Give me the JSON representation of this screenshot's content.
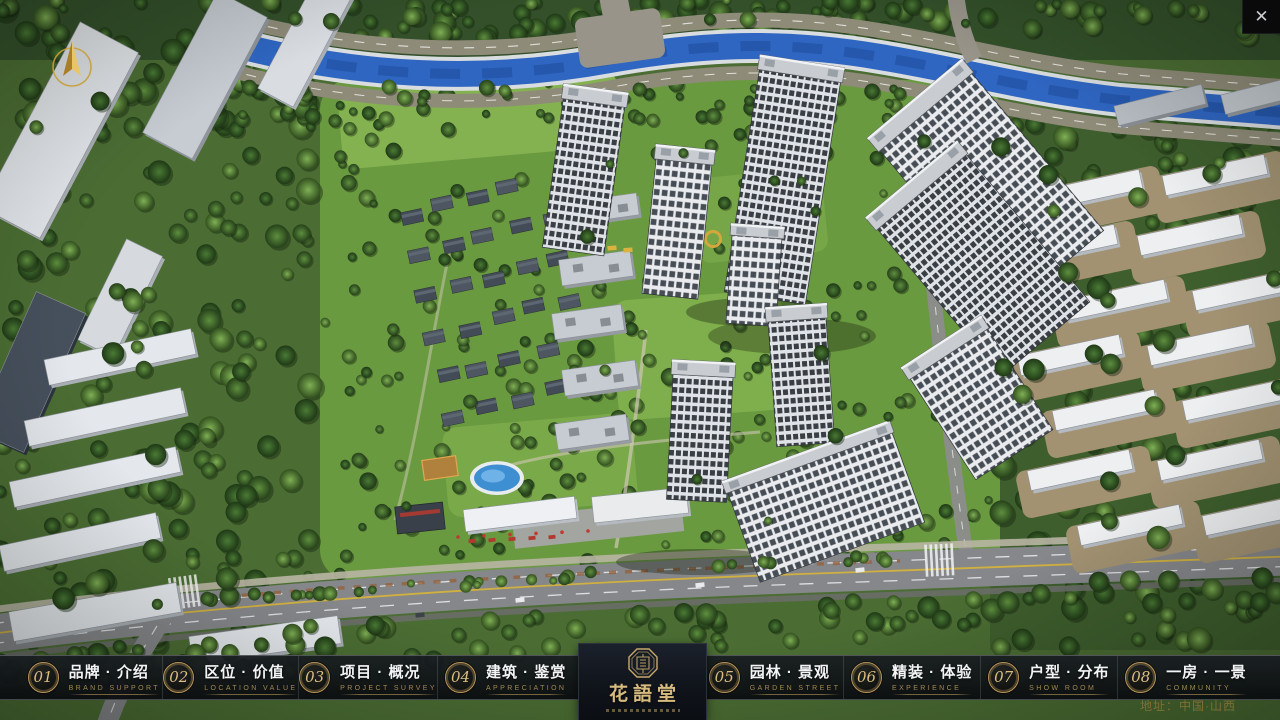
{
  "window": {
    "close_glyph": "✕"
  },
  "logo": {
    "title_cn": "花語堂"
  },
  "footer": {
    "address": "地址：中国·山西"
  },
  "nav": {
    "items": [
      {
        "num": "01",
        "label_cn": "品牌 · 介绍",
        "label_en": "BRAND SUPPORT"
      },
      {
        "num": "02",
        "label_cn": "区位 · 价值",
        "label_en": "LOCATION VALUE"
      },
      {
        "num": "03",
        "label_cn": "项目 · 概况",
        "label_en": "PROJECT SURVEY"
      },
      {
        "num": "04",
        "label_cn": "建筑 · 鉴赏",
        "label_en": "APPRECIATION"
      },
      {
        "num": "05",
        "label_cn": "园林 · 景观",
        "label_en": "GARDEN STREET"
      },
      {
        "num": "06",
        "label_cn": "精装 · 体验",
        "label_en": "EXPERIENCE"
      },
      {
        "num": "07",
        "label_cn": "户型 · 分布",
        "label_en": "SHOW ROOM"
      },
      {
        "num": "08",
        "label_cn": "一房 · 一景",
        "label_en": "COMMUNITY"
      }
    ]
  },
  "colors": {
    "gold": "#c9a96a",
    "river": "#2f66c2",
    "nav_bg": "#121519"
  }
}
